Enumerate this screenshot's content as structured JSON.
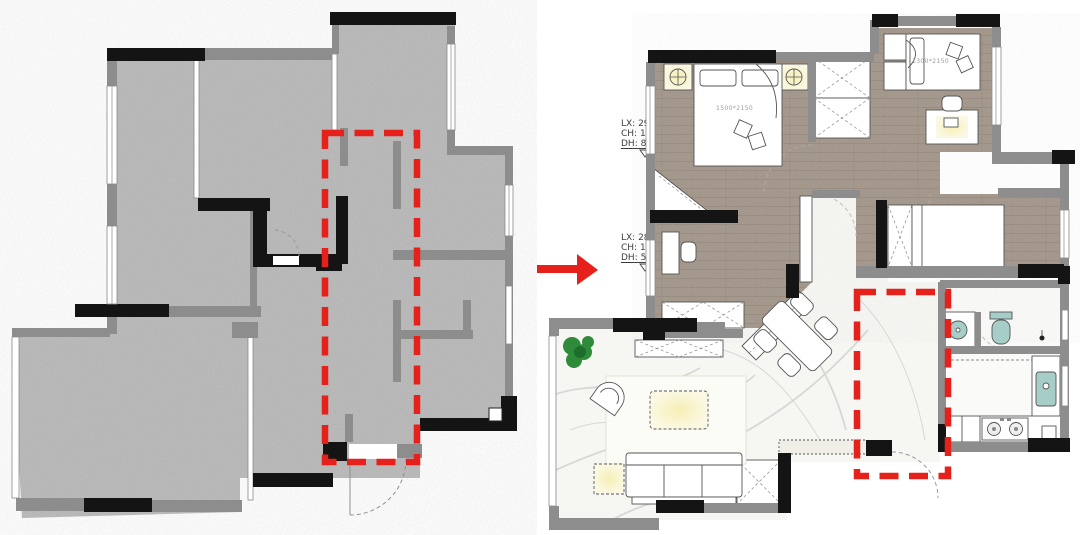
{
  "annotations": {
    "upper": {
      "lx": "LX: 290",
      "ch": "CH: 1640",
      "dh": "DH: 870"
    },
    "lower": {
      "lx": "LX: 280",
      "ch": "CH: 1900",
      "dh": "DH: 510"
    }
  },
  "labels": {
    "master_bed": "1500*2150",
    "guest_bed": "1300*2150"
  },
  "icons": {
    "arrow": "red-arrow-icon",
    "highlight": "red-dashed-highlight-box",
    "lamp": "ceiling-lamp-icon",
    "plant": "plant-icon",
    "stove": "stove-burners-icon",
    "sink": "kitchen-sink-icon",
    "basin": "wash-basin-icon",
    "toilet": "toilet-icon",
    "door": "door-swing-icon"
  },
  "colors": {
    "highlight_red": "#e6201a",
    "wall_black": "#141414",
    "wall_gray": "#8d8d8d",
    "concrete_floor": "#b7b7b7",
    "wood_floor": "#a3968a",
    "marble_floor": "#f6f6f3",
    "bath_floor": "#fafaf8",
    "fixture_teal": "#a6cdc7",
    "glow_yellow": "#f6efb4",
    "glow_yellow_edge": "#fbf8e3",
    "plant_green": "#2e8b3a",
    "furniture_stroke": "#555555",
    "annotation_text": "#3b3b3b",
    "label_gray": "#9c9c9c",
    "vein_gray": "#cdcdcd"
  }
}
